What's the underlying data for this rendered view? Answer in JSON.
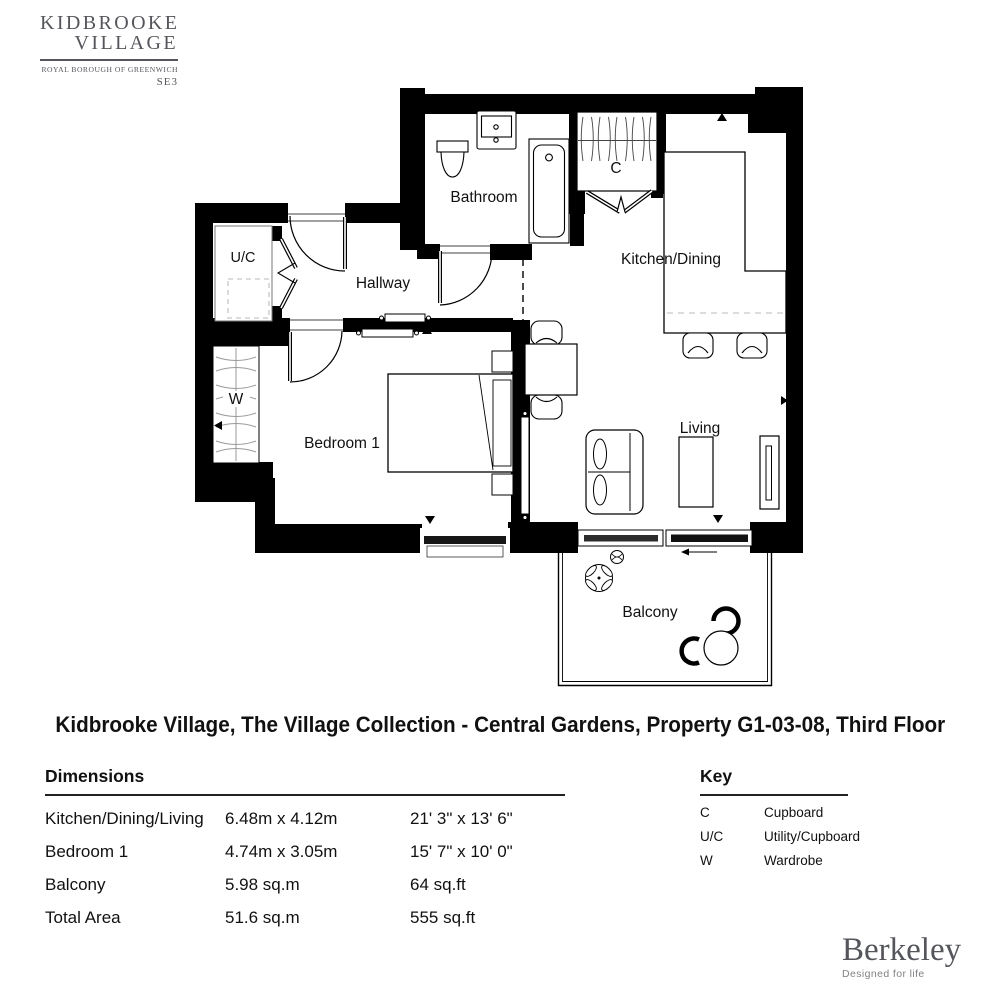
{
  "brand": {
    "line1": "KIDBROOKE",
    "line2": "VILLAGE",
    "borough": "ROYAL BOROUGH OF GREENWICH",
    "postcode": "SE3",
    "color": "#54565b"
  },
  "plan": {
    "rooms": {
      "bathroom": "Bathroom",
      "cupboard": "C",
      "kitchen_dining": "Kitchen/Dining",
      "hallway": "Hallway",
      "utility": "U/C",
      "wardrobe": "W",
      "bedroom1": "Bedroom 1",
      "living": "Living",
      "balcony": "Balcony"
    }
  },
  "title": "Kidbrooke Village, The Village Collection - Central Gardens, Property G1-03-08, Third Floor",
  "dimensions": {
    "heading": "Dimensions",
    "rows": [
      {
        "label": "Kitchen/Dining/Living",
        "metric": "6.48m x 4.12m",
        "imperial": "21' 3\" x 13' 6\""
      },
      {
        "label": "Bedroom 1",
        "metric": "4.74m x 3.05m",
        "imperial": "15' 7\" x 10' 0\""
      },
      {
        "label": "Balcony",
        "metric": "5.98 sq.m",
        "imperial": "64 sq.ft"
      },
      {
        "label": "Total Area",
        "metric": "51.6 sq.m",
        "imperial": "555 sq.ft"
      }
    ]
  },
  "key": {
    "heading": "Key",
    "items": [
      {
        "abbr": "C",
        "meaning": "Cupboard"
      },
      {
        "abbr": "U/C",
        "meaning": "Utility/Cupboard"
      },
      {
        "abbr": "W",
        "meaning": "Wardrobe"
      }
    ]
  },
  "footer": {
    "name": "Berkeley",
    "tagline": "Designed for life"
  }
}
